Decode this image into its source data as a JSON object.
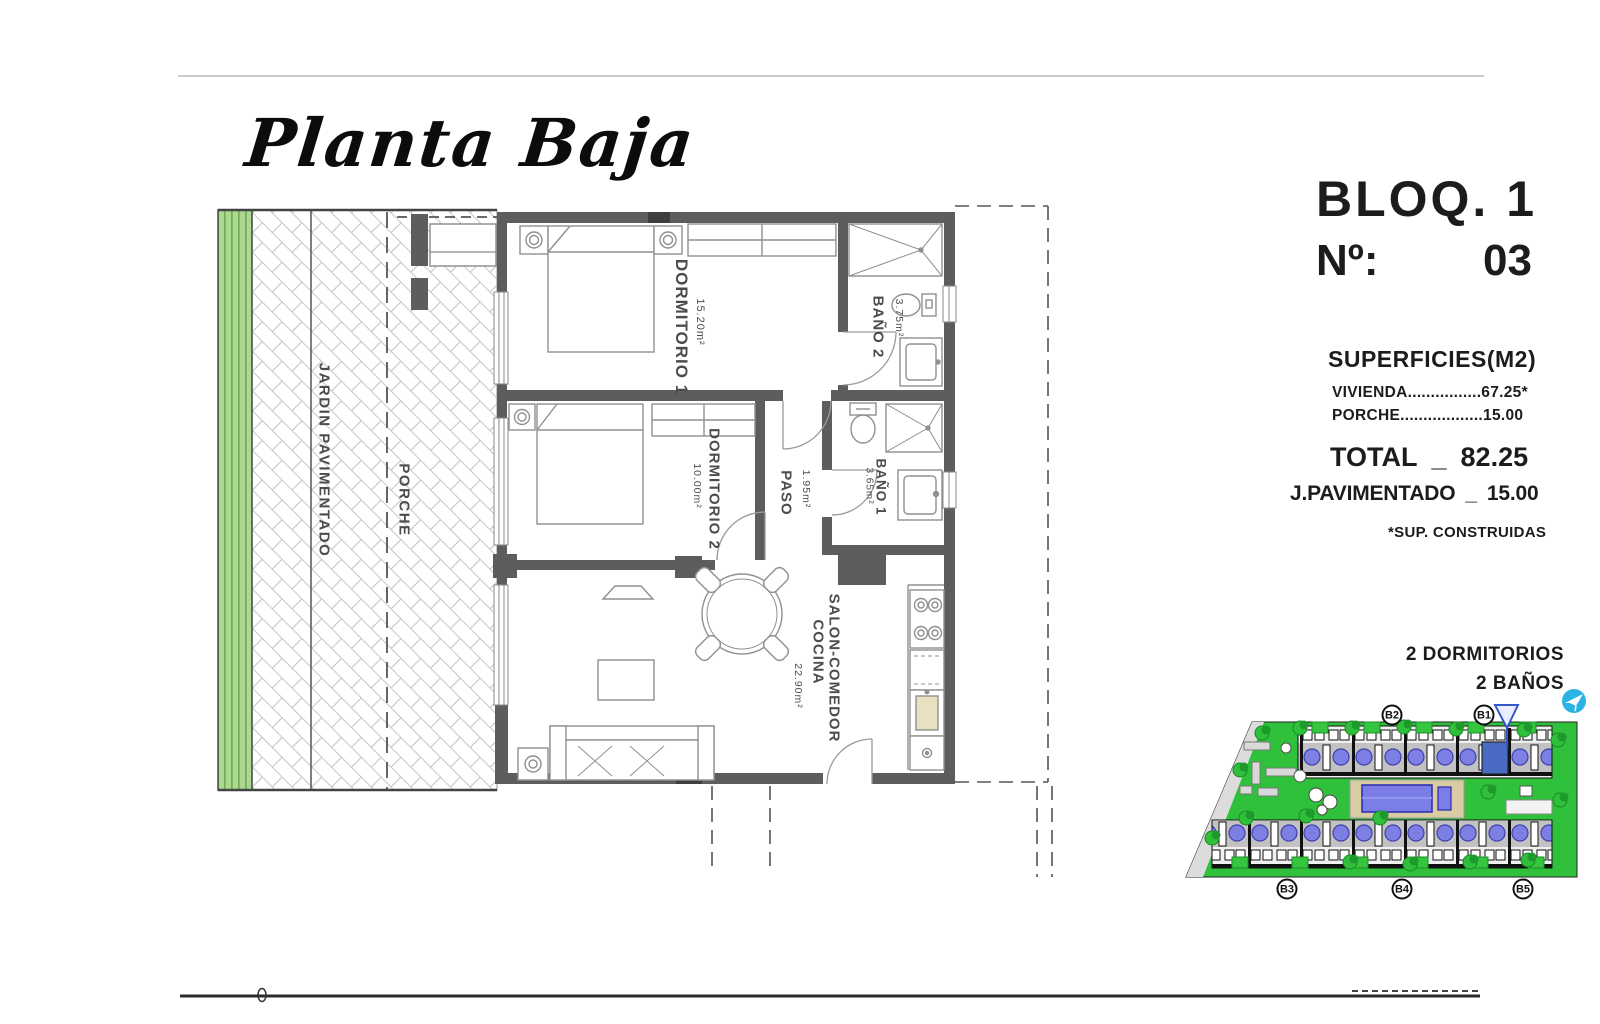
{
  "sheet": {
    "title": "Planta Baja"
  },
  "panel": {
    "block": "BLOQ. 1",
    "number_label": "Nº:",
    "number_value": "03",
    "superficies_title": "SUPERFICIES(M2)",
    "vivienda_row": "VIVIENDA................67.25*",
    "porche_row": "PORCHE..................15.00",
    "total_label": "TOTAL",
    "total_sep": "_",
    "total_value": "82.25",
    "jpav_label": "J.PAVIMENTADO",
    "jpav_sep": "_",
    "jpav_value": "15.00",
    "footnote": "*SUP. CONSTRUIDAS",
    "feature_bedrooms": "2 DORMITORIOS",
    "feature_baths": "2 BAÑOS"
  },
  "plan": {
    "outdoor": {
      "jardin": "JARDIN PAVIMENTADO",
      "porche": "PORCHE"
    },
    "rooms": {
      "dorm1": {
        "name": "DORMITORIO 1",
        "area": "15.20m²"
      },
      "bano2": {
        "name": "BAÑO 2",
        "area": "3.75m²"
      },
      "dorm2": {
        "name": "DORMITORIO 2",
        "area": "10.00m²"
      },
      "paso": {
        "name": "PASO",
        "area": "1.95m²"
      },
      "bano1": {
        "name": "BAÑO 1",
        "area": "3.65m²"
      },
      "cocina": {
        "name": "COCINA",
        "name2": "SALON-COMEDOR",
        "area": "22.90m²"
      }
    }
  },
  "siteplan": {
    "badges": {
      "b2": "B2",
      "b1": "B1",
      "b3": "B3",
      "b4": "B4",
      "b5": "B5"
    },
    "icons": {
      "logo": "paper-plane-logo",
      "marker": "unit-location-marker"
    }
  }
}
